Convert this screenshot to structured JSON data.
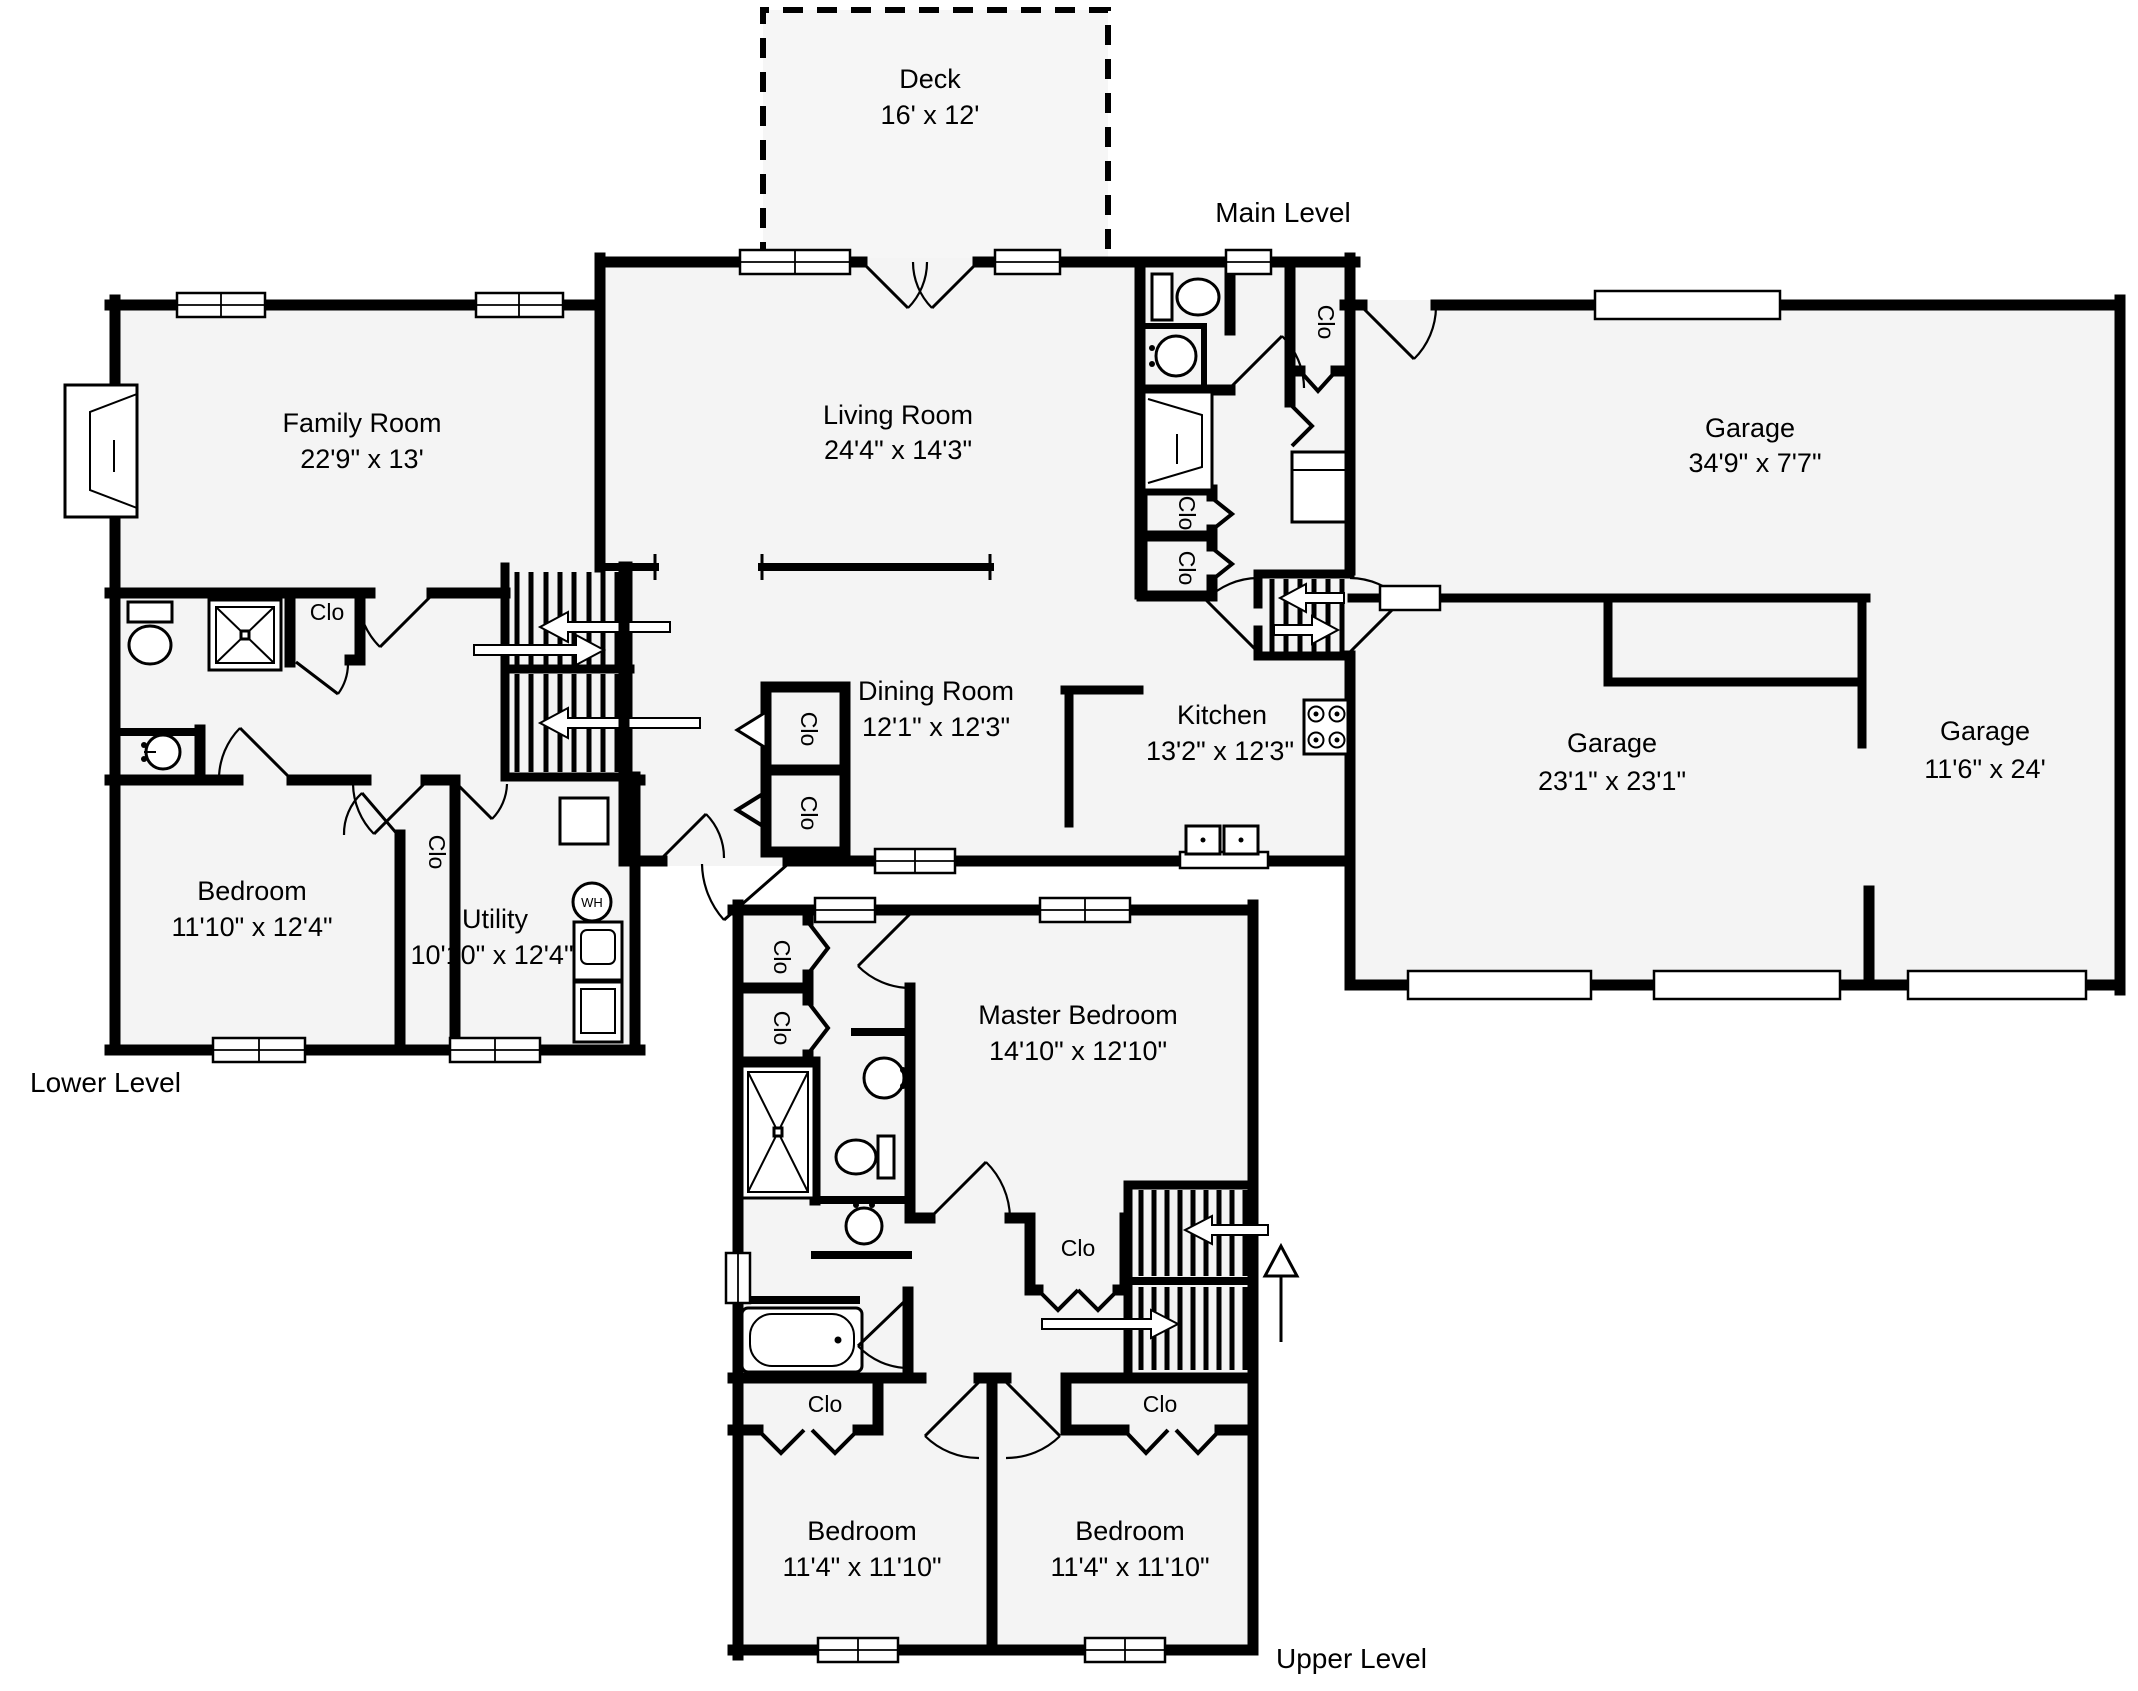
{
  "plan": {
    "levels": {
      "main": "Main Level",
      "lower": "Lower Level",
      "upper": "Upper Level"
    },
    "closet": "Clo",
    "water_heater": "WH",
    "colors": {
      "wall": "#000000",
      "room_fill": "#f4f4f4",
      "background": "#ffffff"
    },
    "rooms": {
      "deck": {
        "name": "Deck",
        "dims": "16' x 12'"
      },
      "living_room": {
        "name": "Living Room",
        "dims": "24'4\" x 14'3\""
      },
      "family_room": {
        "name": "Family Room",
        "dims": "22'9\" x 13'"
      },
      "garage_rear": {
        "name": "Garage",
        "dims": "34'9\" x 7'7\""
      },
      "garage_main": {
        "name": "Garage",
        "dims": "23'1\" x 23'1\""
      },
      "garage_side": {
        "name": "Garage",
        "dims": "11'6\" x 24'"
      },
      "dining_room": {
        "name": "Dining Room",
        "dims": "12'1\" x 12'3\""
      },
      "kitchen": {
        "name": "Kitchen",
        "dims": "13'2\" x 12'3\""
      },
      "bedroom_lower": {
        "name": "Bedroom",
        "dims": "11'10\" x 12'4\""
      },
      "utility": {
        "name": "Utility",
        "dims": "10'10\" x 12'4\""
      },
      "master_bedroom": {
        "name": "Master Bedroom",
        "dims": "14'10\" x 12'10\""
      },
      "bedroom_left": {
        "name": "Bedroom",
        "dims": "11'4\" x 11'10\""
      },
      "bedroom_right": {
        "name": "Bedroom",
        "dims": "11'4\" x 11'10\""
      }
    }
  }
}
